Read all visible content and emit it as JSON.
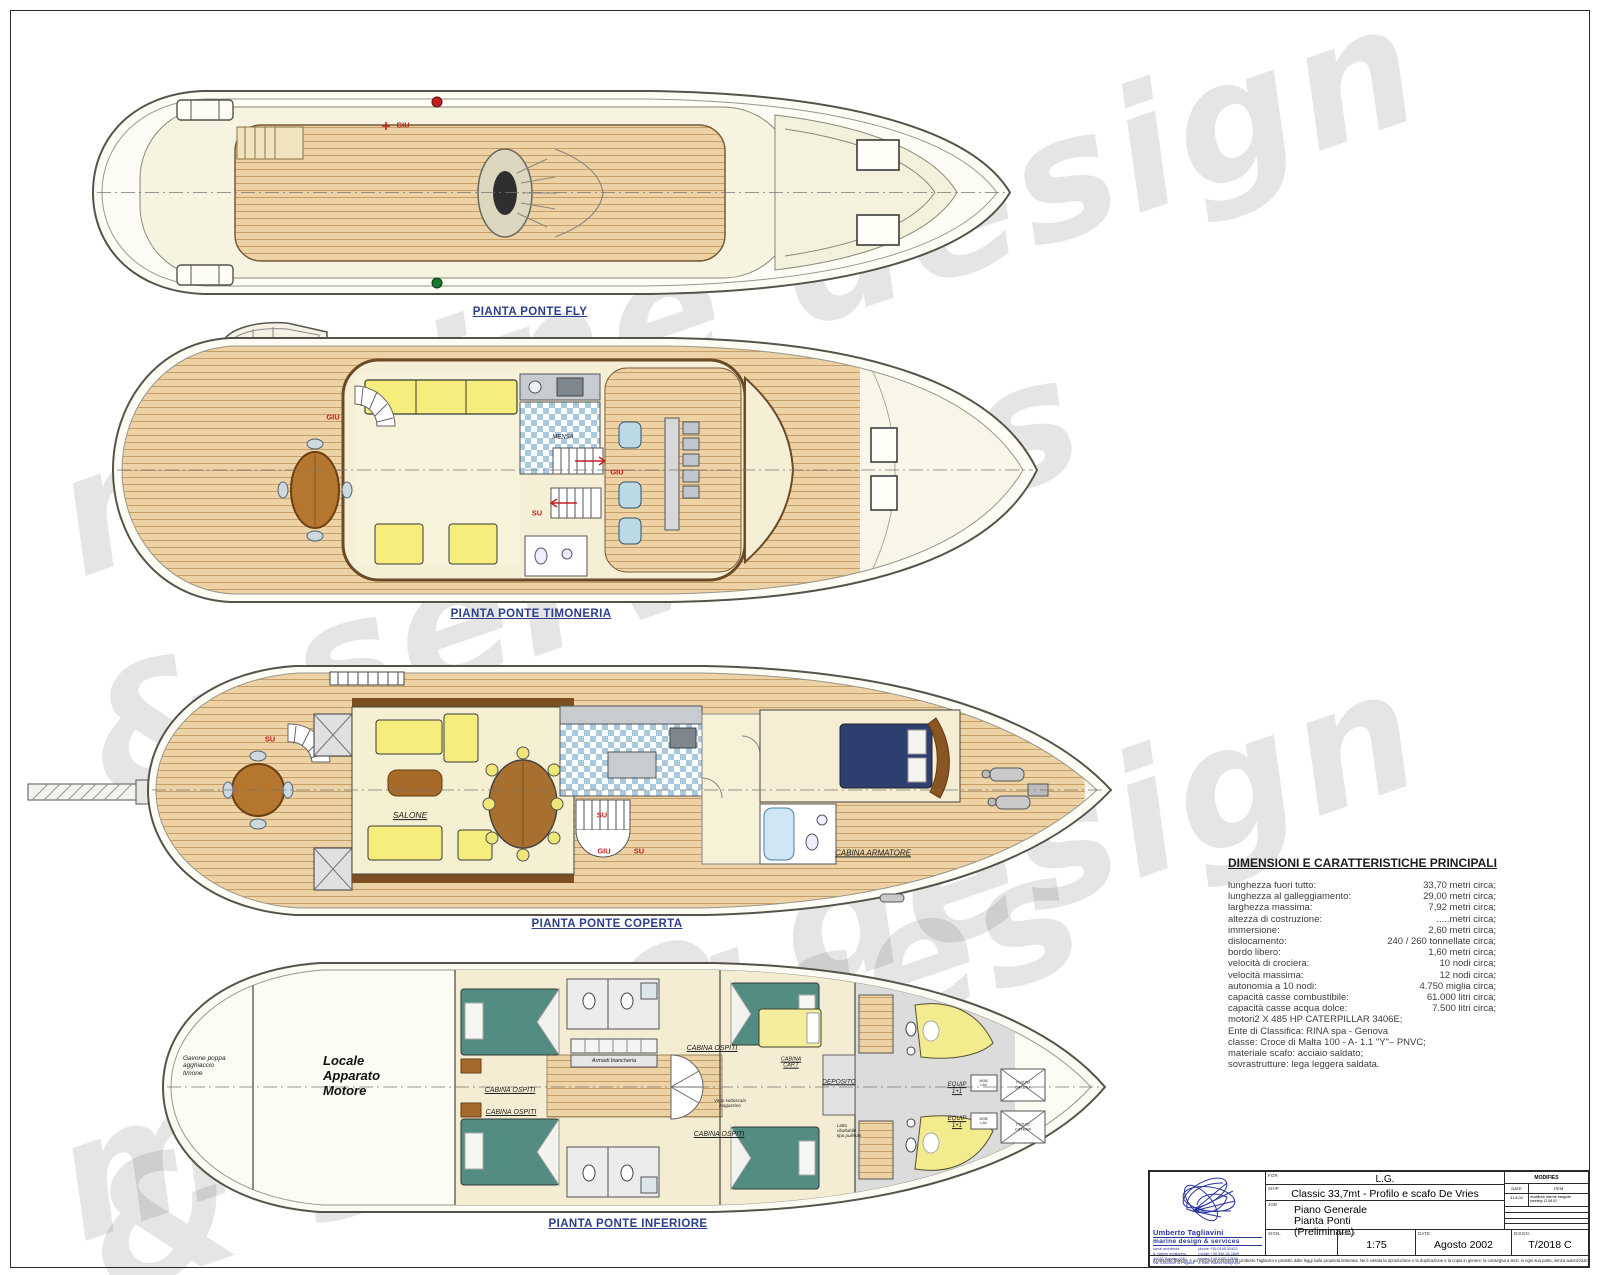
{
  "watermark": {
    "line1": "marine design",
    "line2": "& services"
  },
  "palette": {
    "label_blue": "#2b3f8c",
    "annotation_red": "#c02020",
    "deck_wood": "#ecd2a4",
    "teal_bed": "#528c82",
    "navy_bed": "#2c3f6e",
    "furniture_yellow": "#f5ee7c",
    "logo_blue": "#2a35a0",
    "watermark_gray": "#d9d9d9",
    "tile_blue": "#a9c9de"
  },
  "decks": [
    {
      "label": "PIANTA PONTE FLY",
      "ann": {
        "giu": "GIU"
      }
    },
    {
      "label": "PIANTA PONTE TIMONERIA",
      "ann": {
        "giu_aft": "GIU",
        "giu": "GIU",
        "su": "SU",
        "mensa": "MENSA"
      }
    },
    {
      "label": "PIANTA PONTE COPERTA",
      "ann": {
        "su_aft": "SU",
        "su_mid": "SU",
        "giu": "GIU",
        "su2": "SU",
        "salone": "SALONE",
        "cabina_armatore": "CABINA ARMATORE"
      }
    },
    {
      "label": "PIANTA PONTE INFERIORE",
      "ann": {
        "gavone": "Gavone poppa\nagghiaccio\ntimone",
        "locale": "Locale\nApparato\nMotore",
        "cabina_ospiti": "CABINA OSPITI",
        "armadi": "Armadi biancheria",
        "cabina_capt": "CABINA\nCAP.T",
        "deposito": "DEPOSITO",
        "vano": "Vano sottoscala\nmagazzino",
        "letto": "Letto\nribaltabile\ntipo pullman",
        "equip": "EQUIP\n1+1",
        "mob": "MOB.\nLAV.",
        "pozzo": "POZZO\nCATENA"
      }
    }
  ],
  "dimensions": {
    "title": "DIMENSIONI E CARATTERISTICHE PRINCIPALI",
    "rows": [
      {
        "label": "lunghezza fuori tutto:",
        "value": "33,70 metri circa;"
      },
      {
        "label": "lunghezza al galleggiamento:",
        "value": "29,00 metri circa;"
      },
      {
        "label": "larghezza massima:",
        "value": "7,92 metri circa;"
      },
      {
        "label": "altezza di costruzione:",
        "value": ".....metri circa;"
      },
      {
        "label": "immersione:",
        "value": "2,60 metri circa;"
      },
      {
        "label": "dislocamento:",
        "value": "240 / 260 tonnellate circa;"
      },
      {
        "label": "bordo libero:",
        "value": "1,60 metri circa;"
      },
      {
        "label": "velocità di crociera:",
        "value": "10 nodi  circa;"
      },
      {
        "label": "velocità massima:",
        "value": "12 nodi circa;"
      },
      {
        "label": "autonomia a 10 nodi:",
        "value": "4.750 miglia circa;"
      },
      {
        "label": "capacità casse combustibile:",
        "value": "61.000 litri circa;"
      },
      {
        "label": "capacità casse acqua dolce:",
        "value": "7.500 litri circa;"
      }
    ],
    "notes": [
      "motori2 X 485 HP CATERPILLAR 3406E;",
      "Ente di Classifica: RINA spa - Genova",
      "classe: Croce di Malta 100 - A- 1.1 \"Y\"– PNVC;",
      "materiale scafo: acciaio saldato;",
      "sovrastrutture: lega leggera saldata."
    ]
  },
  "title_block": {
    "for_label": "FOR",
    "for_value": "L.G.",
    "ship_label": "SHIP",
    "ship_value": "Classic 33,7mt - Profilo e scafo De Vries",
    "job_label": "JOB",
    "job_value": "Piano Generale\nPianta Ponti\n(Preliminare)",
    "modifies_label": "MODIFIES",
    "modifies_date_label": "DATE",
    "modifies_item_label": "ITEM",
    "modifies_rows": [
      {
        "date": "31.8.02",
        "item": "modifiche interne eseguite\nmeeting 12.08.02"
      }
    ],
    "sign_label": "SIGN.",
    "scale_label": "SCALE",
    "scale_value": "1:75",
    "date_label": "DATE",
    "date_value": "Agosto 2002",
    "disgn_label": "DISGN.",
    "disgn_value": "T/2018 C",
    "logo_name": "Umberto Tagliavini",
    "logo_tagline": "marine design & services",
    "contact_left": "naval architects\n& marine engineers\n16035 Rapallo (GE)\nVia S.Michele di Pagana",
    "contact_right": "phone +39.0185.52403\nmobile +39.335.25.2809\ntelefax +39.0185.23084\ne-mail: marine.design@it",
    "disclaimer": "Il presente disegno è ad esclusiva proprietà di Umberto Tagliavini e protetto dalle leggi sulla proprietà letteraria. Ne è vietata la riproduzione e la duplicazione e la copia in genere; la consegna a terzi, in ogni sua parte, senza autorizzazione scritta."
  }
}
